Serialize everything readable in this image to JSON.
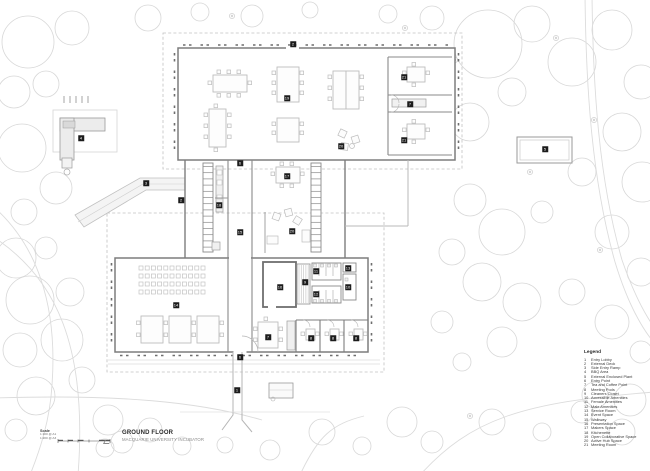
{
  "title_block": {
    "scale_label": "Scale",
    "scale_ratios": [
      "1:100 @ A1",
      "1:200 @ A3"
    ],
    "title": "GROUND FLOOR",
    "subtitle": "MACQUARIE UNIVERSITY INCUBATOR"
  },
  "legend": {
    "heading": "Legend",
    "items": [
      {
        "num": "1",
        "label": "Entry Lobby"
      },
      {
        "num": "2",
        "label": "External Deck"
      },
      {
        "num": "3",
        "label": "Side Entry Ramp"
      },
      {
        "num": "4",
        "label": "BBQ Area"
      },
      {
        "num": "5",
        "label": "External Enclosed Plant"
      },
      {
        "num": "6",
        "label": "Entry Point"
      },
      {
        "num": "7",
        "label": "Tea and Coffee Point"
      },
      {
        "num": "8",
        "label": "Meeting Pods"
      },
      {
        "num": "9",
        "label": "Cleaners Closet"
      },
      {
        "num": "10",
        "label": "Accessible Amenities"
      },
      {
        "num": "11",
        "label": "Female Amenities"
      },
      {
        "num": "12",
        "label": "Male Amenities"
      },
      {
        "num": "13",
        "label": "Service Room"
      },
      {
        "num": "14",
        "label": "Event Space"
      },
      {
        "num": "15",
        "label": "Walkway"
      },
      {
        "num": "16",
        "label": "Presentation Space"
      },
      {
        "num": "17",
        "label": "Makers Space"
      },
      {
        "num": "18",
        "label": "Kitchenette"
      },
      {
        "num": "19",
        "label": "Open Collaborative Space"
      },
      {
        "num": "20",
        "label": "Active Hub Space"
      },
      {
        "num": "21",
        "label": "Meeting Room"
      }
    ]
  },
  "plan": {
    "markers": [
      {
        "num": "1",
        "x": 237,
        "y": 390
      },
      {
        "num": "2",
        "x": 293,
        "y": 44
      },
      {
        "num": "2",
        "x": 181,
        "y": 200
      },
      {
        "num": "3",
        "x": 146,
        "y": 183
      },
      {
        "num": "4",
        "x": 81,
        "y": 138
      },
      {
        "num": "5",
        "x": 545,
        "y": 149
      },
      {
        "num": "6",
        "x": 240,
        "y": 357
      },
      {
        "num": "6",
        "x": 240,
        "y": 163
      },
      {
        "num": "7",
        "x": 410,
        "y": 104
      },
      {
        "num": "7",
        "x": 268,
        "y": 337
      },
      {
        "num": "8",
        "x": 311,
        "y": 338
      },
      {
        "num": "8",
        "x": 333,
        "y": 338
      },
      {
        "num": "8",
        "x": 356,
        "y": 338
      },
      {
        "num": "9",
        "x": 305,
        "y": 282
      },
      {
        "num": "10",
        "x": 348,
        "y": 287
      },
      {
        "num": "11",
        "x": 316,
        "y": 271
      },
      {
        "num": "12",
        "x": 316,
        "y": 294
      },
      {
        "num": "13",
        "x": 348,
        "y": 268
      },
      {
        "num": "14",
        "x": 176,
        "y": 305
      },
      {
        "num": "15",
        "x": 240,
        "y": 232
      },
      {
        "num": "16",
        "x": 280,
        "y": 287
      },
      {
        "num": "17",
        "x": 287,
        "y": 176
      },
      {
        "num": "18",
        "x": 219,
        "y": 205
      },
      {
        "num": "19",
        "x": 287,
        "y": 98
      },
      {
        "num": "20",
        "x": 292,
        "y": 231
      },
      {
        "num": "20",
        "x": 341,
        "y": 146
      },
      {
        "num": "21",
        "x": 404,
        "y": 77
      },
      {
        "num": "21",
        "x": 404,
        "y": 140
      }
    ]
  },
  "colors": {
    "wall": "#7d7d7d",
    "interior_wall": "#8a8a8a",
    "furniture": "#bdbdbd",
    "vegetation": "#d7d7d7",
    "boundary_dash": "#c2c2c2",
    "marker_bg": "#1c1c1c",
    "marker_text": "#ffffff",
    "title_text": "#2b2b2b",
    "subtitle_text": "#8a8a8a"
  }
}
